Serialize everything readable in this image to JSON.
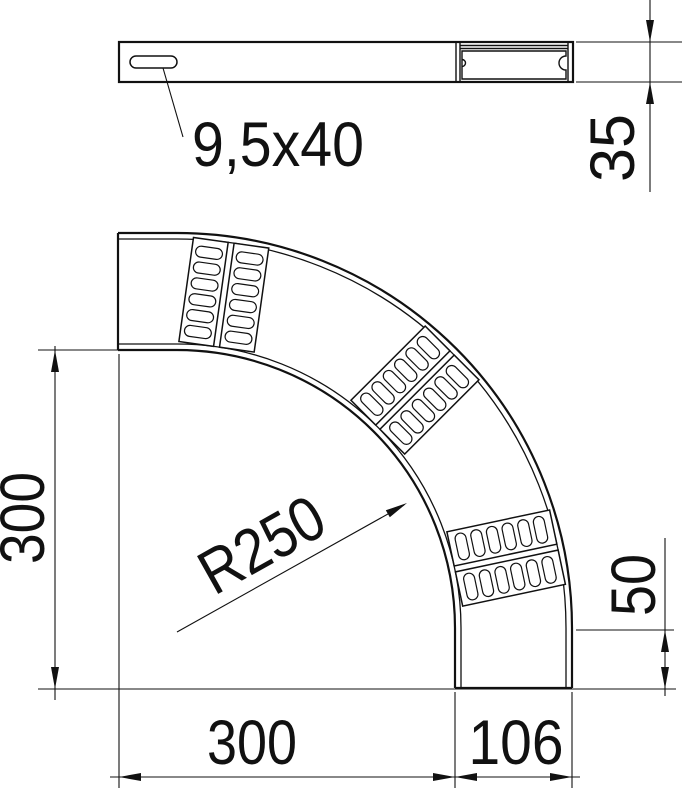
{
  "drawing": {
    "line_color": "#111111",
    "background": "#ffffff",
    "top_view": {
      "slot_label": "9,5x40",
      "height_dim": "35"
    },
    "bend_view": {
      "radius_label": "R250",
      "side_dim": "300",
      "bottom_dim": "300",
      "width_dim": "106",
      "tangent_dim": "50"
    }
  }
}
